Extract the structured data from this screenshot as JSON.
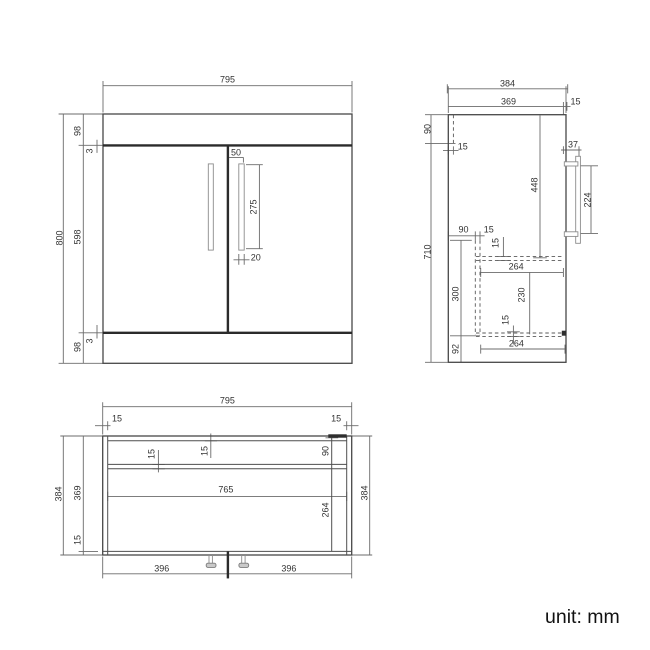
{
  "unit_label": "unit: mm",
  "colors": {
    "line": "#5f5f5f",
    "dark_line": "#2b2b2b",
    "text": "#333333",
    "background": "#ffffff"
  },
  "views": {
    "front": {
      "dims": {
        "overall_width": "795",
        "overall_height": "800",
        "top_rail": "98",
        "top_gap": "3",
        "door_height": "598",
        "bottom_gap": "3",
        "bottom_rail": "98",
        "handle_offset": "50",
        "handle_length": "275",
        "handle_width": "20"
      }
    },
    "side": {
      "dims": {
        "overall_depth": "384",
        "carcass_depth": "369",
        "front_clearance": "15",
        "back_rail_height": "90",
        "back_panel": "15",
        "overall_height": "710",
        "top_to_shelf": "448",
        "handle_offset": "37",
        "handle_length": "224",
        "shelf_setback": "90",
        "divider": "15",
        "shelf_thickness": "15",
        "shelf_width": "264",
        "interior_height": "300",
        "drawer_height": "230",
        "bottom_thickness": "15",
        "bottom_width": "264",
        "plinth_height": "92"
      }
    },
    "plan": {
      "dims": {
        "overall_width": "795",
        "left_panel": "15",
        "right_panel": "15",
        "overall_depth_left": "384",
        "carcass_depth": "369",
        "bottom_panel": "15",
        "overall_depth_right": "384",
        "back_panel": "15",
        "mid_panel": "15",
        "rail_depth": "90",
        "interior_width": "765",
        "interior_depth": "264",
        "leg_span_left": "396",
        "leg_span_right": "396"
      }
    }
  }
}
